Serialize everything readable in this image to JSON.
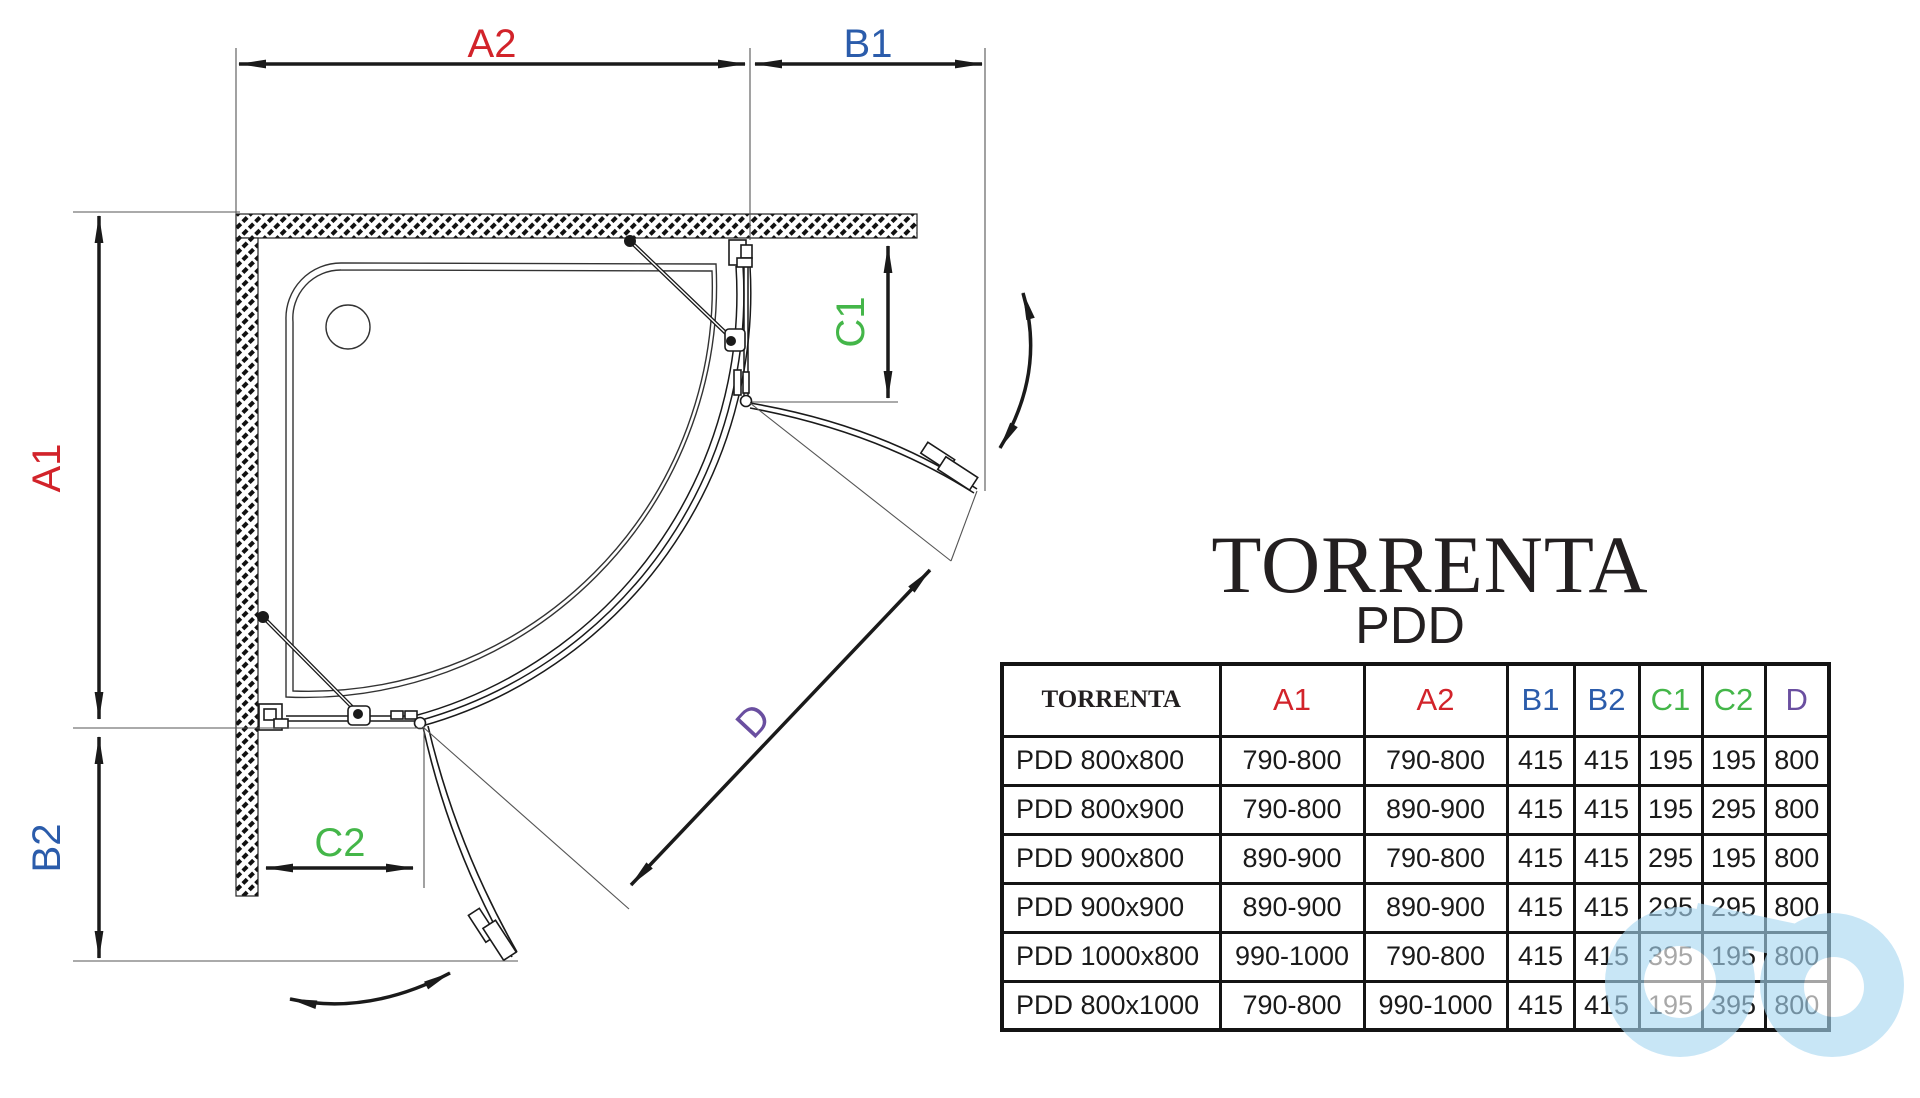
{
  "title": {
    "brand": "TORRENTA",
    "model": "PDD"
  },
  "colors": {
    "red": "#d2232a",
    "blue": "#2b5cab",
    "green": "#44b649",
    "purple": "#6a4fa0",
    "black": "#231f20",
    "line": "#1a1a1a",
    "watermark": "#a8d7f2"
  },
  "diagram": {
    "labels": {
      "a1": "A1",
      "a2": "A2",
      "b1": "B1",
      "b2": "B2",
      "c1": "C1",
      "c2": "C2",
      "d": "D"
    }
  },
  "table": {
    "header": [
      {
        "label": "TORRENTA",
        "color": "black"
      },
      {
        "label": "A1",
        "color": "red"
      },
      {
        "label": "A2",
        "color": "red"
      },
      {
        "label": "B1",
        "color": "blue"
      },
      {
        "label": "B2",
        "color": "blue"
      },
      {
        "label": "C1",
        "color": "green"
      },
      {
        "label": "C2",
        "color": "green"
      },
      {
        "label": "D",
        "color": "purple"
      }
    ],
    "rows": [
      [
        "PDD 800x800",
        "790-800",
        "790-800",
        "415",
        "415",
        "195",
        "195",
        "800"
      ],
      [
        "PDD 800x900",
        "790-800",
        "890-900",
        "415",
        "415",
        "195",
        "295",
        "800"
      ],
      [
        "PDD 900x800",
        "890-900",
        "790-800",
        "415",
        "415",
        "295",
        "195",
        "800"
      ],
      [
        "PDD 900x900",
        "890-900",
        "890-900",
        "415",
        "415",
        "295",
        "295",
        "800"
      ],
      [
        "PDD 1000x800",
        "990-1000",
        "790-800",
        "415",
        "415",
        "395",
        "195",
        "800"
      ],
      [
        "PDD 800x1000",
        "790-800",
        "990-1000",
        "415",
        "415",
        "195",
        "395",
        "800"
      ]
    ]
  }
}
